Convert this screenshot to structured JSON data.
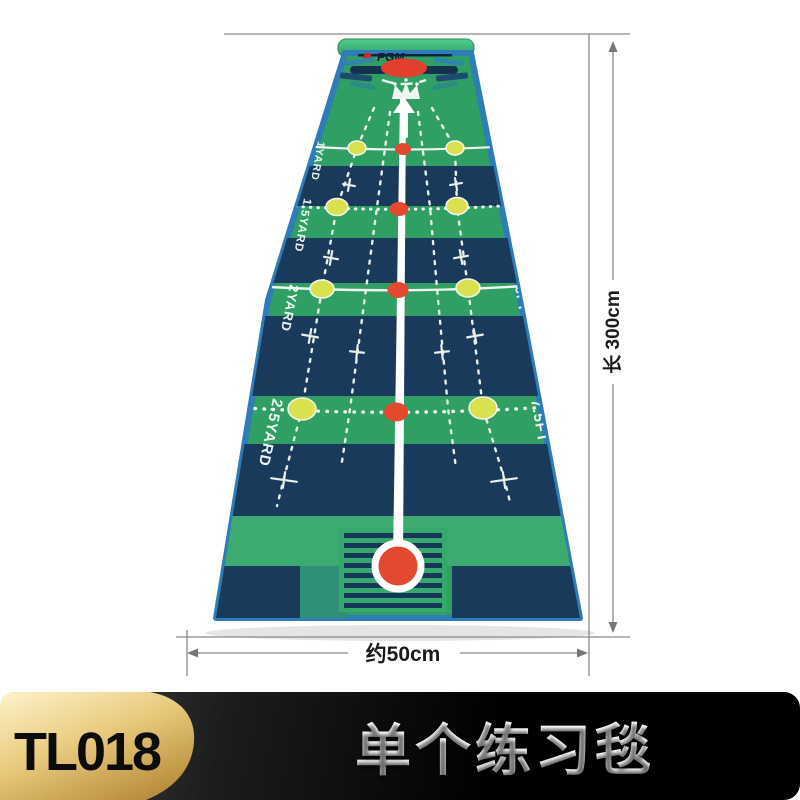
{
  "product": {
    "brand_logo": "PGM",
    "left_labels": [
      "1YARD",
      "1.5YARD",
      "2YARD",
      "2.5YARD"
    ],
    "right_labels": [
      "3FT",
      "4.5FT",
      "6FT",
      "7.5FT"
    ]
  },
  "dimensions": {
    "length": "长 300cm",
    "width": "约50cm"
  },
  "banner": {
    "model": "TL018",
    "title": "单个练习毯"
  },
  "colors": {
    "mat_green": "#2f9f63",
    "mat_green_light": "#3cab72",
    "mat_navy": "#1a3a5c",
    "mat_border_blue": "#2e7cb8",
    "roll_green": "#45c286",
    "dot_yellow": "#d9e14e",
    "dot_red": "#e2492e",
    "badge_gold": "#d8b45e",
    "banner_black": "#0a0a0a"
  }
}
